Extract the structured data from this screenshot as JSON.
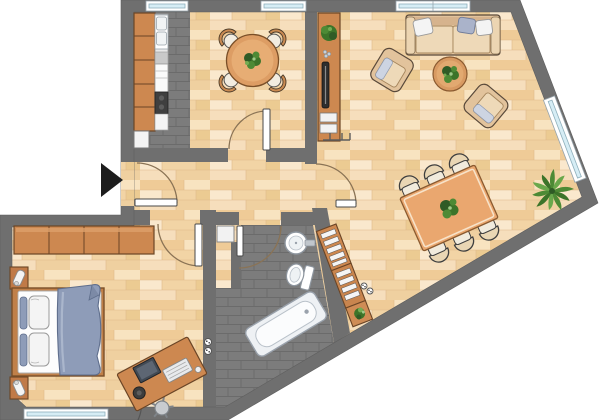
{
  "title": "Apartment floor plan",
  "palette": {
    "wall": "#6f6f6f",
    "wallEdge": "#5e5e5e",
    "woodBase": "#f5d9ae",
    "tileBase": "#7c7c7c",
    "tileLine": "#6b6b6b",
    "furnitureWood": "#cd8850",
    "furnitureWoodDark": "#6b4526",
    "tableWood": "#eaa76f",
    "sofaBeige": "#e2c39c",
    "cushionBeige": "#eed9b8",
    "fabricBlue": "#8e9cb8",
    "pillowWhite": "#f4f4f4",
    "fixtureWhite": "#ffffff",
    "fixtureOutline": "#8d959e",
    "tubShell": "#eef1f4",
    "plantDark": "#2f5b26",
    "plantMid": "#4d8a35",
    "plantLight": "#74ac53",
    "windowGlass": "#d6edf5",
    "windowFrame": "#8fb0bc",
    "doorArc": "#8a7355",
    "arrowBlack": "#1d1d1d",
    "applianceDark": "#3f3f3f",
    "monitorDark": "#424a54"
  },
  "plan": {
    "entrance": {
      "marker": "black arrow pointing right at entrance door"
    },
    "windows_count": 5,
    "doors_count": 5,
    "rooms": [
      {
        "name": "kitchen",
        "floor": "dark-tile",
        "items": [
          "kitchen-counter",
          "sink-unit",
          "oven",
          "cooktop",
          "shaft"
        ]
      },
      {
        "name": "dining-room",
        "floor": "wood",
        "items": [
          "round-table",
          "4-chairs",
          "potted-plant"
        ]
      },
      {
        "name": "living-room",
        "floor": "wood",
        "items": [
          "sofa",
          "3-sofa-pillows",
          "2-armchairs",
          "coffee-table",
          "tv-sideboard",
          "tv",
          "stereo",
          "dining-table-6-chairs",
          "wall-shelf",
          "plant-table",
          "palm-plant",
          "coat-rack"
        ]
      },
      {
        "name": "hallway",
        "floor": "wood",
        "items": []
      },
      {
        "name": "bedroom",
        "floor": "wood",
        "items": [
          "wardrobe-4-doors",
          "double-bed",
          "blue-duvet",
          "4-pillows",
          "2-nightstands",
          "2-table-lamps",
          "desk",
          "computer-monitor",
          "keyboard",
          "desk-chair",
          "2-power-outlets"
        ]
      },
      {
        "name": "bathroom",
        "floor": "dark-tile",
        "items": [
          "bathtub",
          "wash-basin",
          "toilet"
        ]
      }
    ]
  }
}
